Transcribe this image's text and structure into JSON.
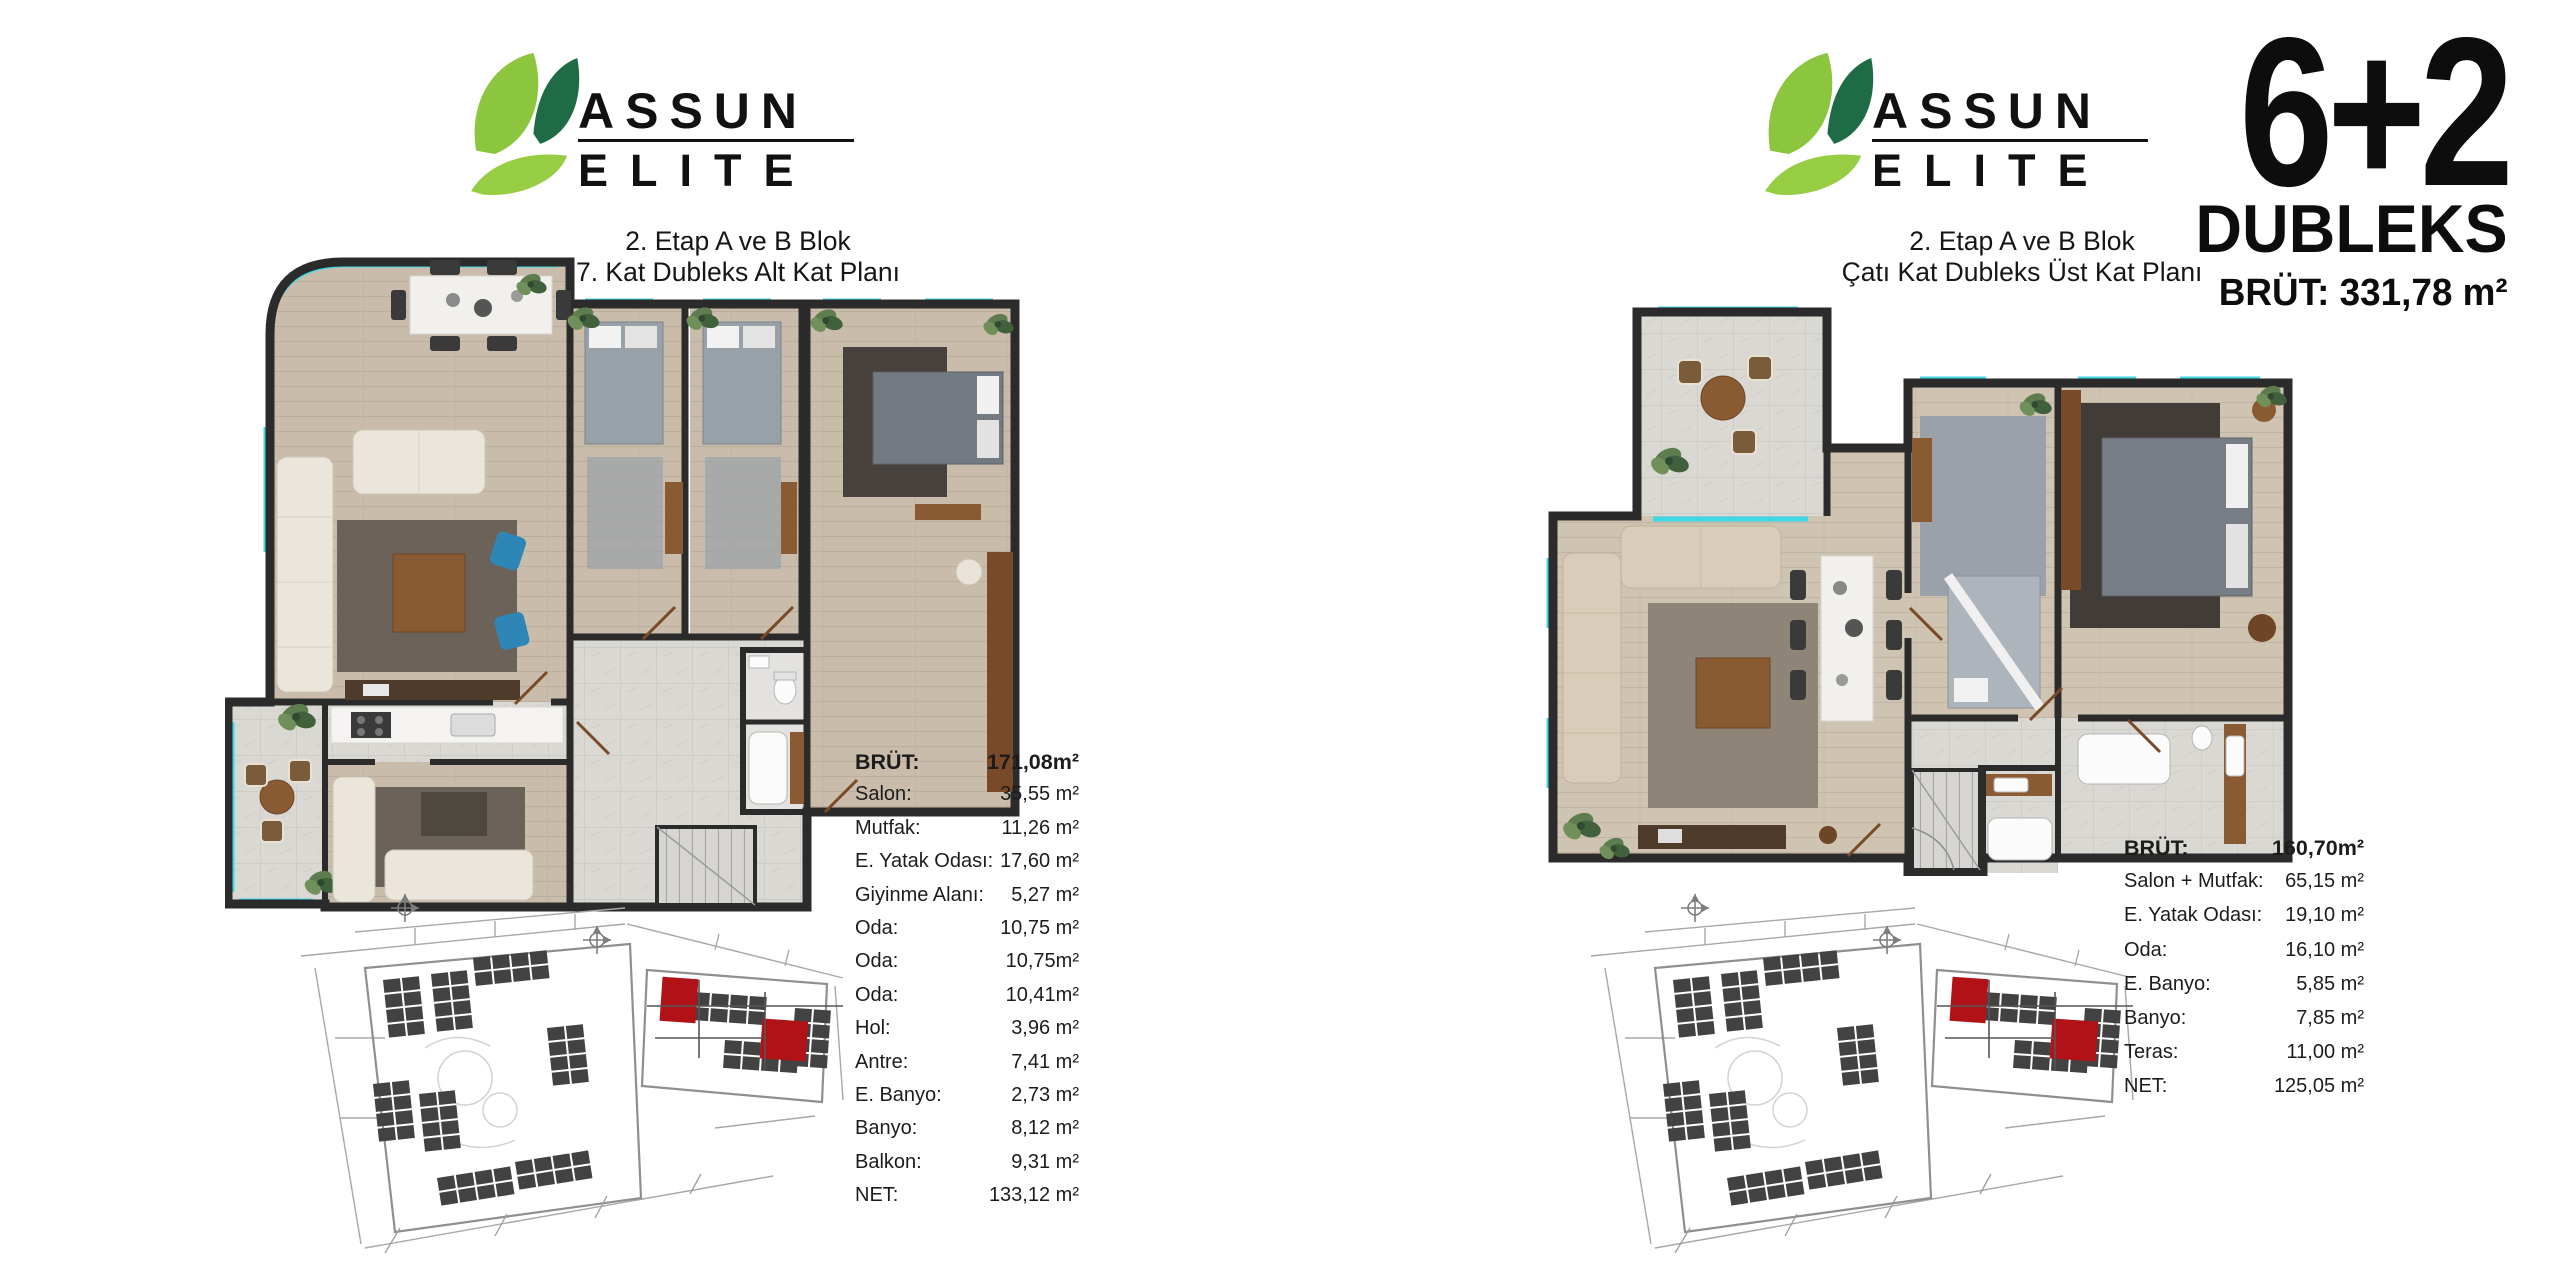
{
  "brand": {
    "line1": "ASSUN",
    "line2": "ELITE"
  },
  "unit_header": {
    "type": "6+2",
    "name": "DUBLEKS",
    "brut": "BRÜT: 331,78 m²"
  },
  "left_panel": {
    "caption_line1": "2. Etap A ve B Blok",
    "caption_line2": "7. Kat Dubleks Alt Kat Planı",
    "area_table": [
      {
        "label": "BRÜT:",
        "value": "171,08m²",
        "bold": true
      },
      {
        "label": "Salon:",
        "value": "35,55 m²"
      },
      {
        "label": "Mutfak:",
        "value": "11,26 m²"
      },
      {
        "label": "E. Yatak Odası:",
        "value": "17,60 m²"
      },
      {
        "label": "Giyinme Alanı:",
        "value": "5,27 m²"
      },
      {
        "label": "Oda:",
        "value": "10,75 m²"
      },
      {
        "label": "Oda:",
        "value": "10,75m²"
      },
      {
        "label": "Oda:",
        "value": "10,41m²"
      },
      {
        "label": "Hol:",
        "value": "3,96 m²"
      },
      {
        "label": "Antre:",
        "value": "7,41 m²"
      },
      {
        "label": "E. Banyo:",
        "value": "2,73 m²"
      },
      {
        "label": "Banyo:",
        "value": "8,12 m²"
      },
      {
        "label": "Balkon:",
        "value": "9,31 m²"
      },
      {
        "label": "NET:",
        "value": "133,12 m²"
      }
    ]
  },
  "right_panel": {
    "caption_line1": "2. Etap A ve B Blok",
    "caption_line2": "Çatı Kat Dubleks Üst Kat Planı",
    "area_table": [
      {
        "label": "BRÜT:",
        "value": "160,70m²",
        "bold": true
      },
      {
        "label": "Salon + Mutfak:",
        "value": "65,15 m²"
      },
      {
        "label": "E. Yatak Odası:",
        "value": "19,10 m²"
      },
      {
        "label": "Oda:",
        "value": "16,10 m²"
      },
      {
        "label": "E. Banyo:",
        "value": "5,85 m²"
      },
      {
        "label": "Banyo:",
        "value": "7,85 m²"
      },
      {
        "label": "Teras:",
        "value": "11,00 m²"
      },
      {
        "label": "NET:",
        "value": "125,05 m²"
      }
    ]
  },
  "colors": {
    "leaf_light": "#8cc63e",
    "leaf_dark": "#1e6b45",
    "window_accent": "#3ed8e6",
    "highlight_block_red": "#b11218",
    "wall": "#2b2b2b"
  }
}
